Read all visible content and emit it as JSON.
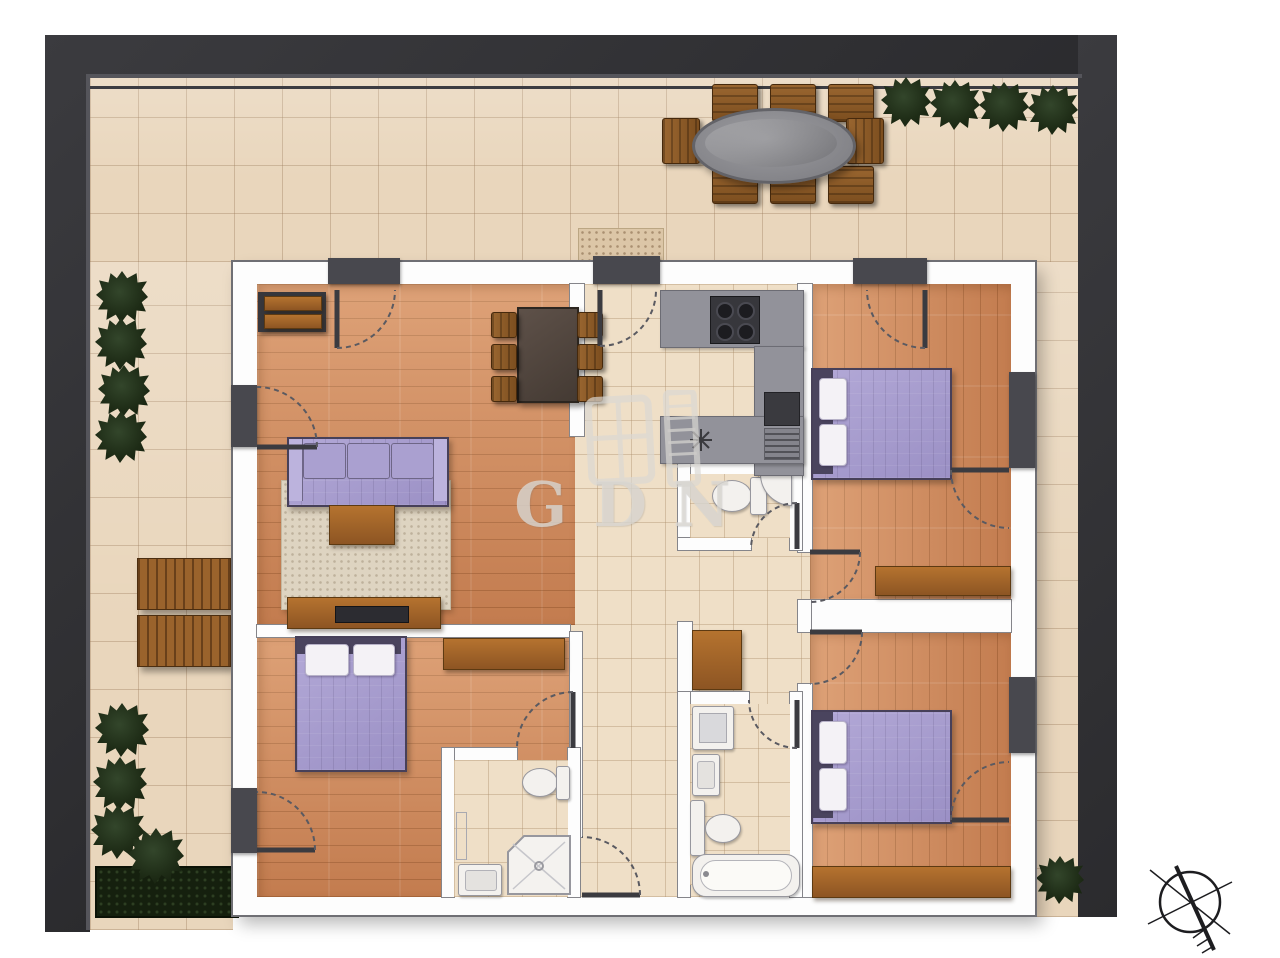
{
  "watermark": {
    "text": "GDN",
    "logo": "window-shutter-icon"
  },
  "compass": {
    "icon": "north-arrow-compass",
    "position": "bottom-right"
  },
  "palette": {
    "frame_dark": "#313135",
    "terrace_tile": "#e9d6bc",
    "indoor_tile": "#efdfc7",
    "wood_floor": "#d1885a",
    "wall_white": "#fdfdfd",
    "counter_gray": "#92929a",
    "appliance_dark": "#37373c",
    "upholstery_purple": "#a79dcd",
    "furniture_wood": "#a0642b",
    "plant_green": "#1f2d17",
    "sanitary_white": "#f3f1ee"
  },
  "floor_plan": {
    "type": "apartment-top-view-render",
    "outdoor": {
      "terrace_shape": "L-wraparound with right-side balcony strip",
      "dining_set": {
        "table": "oval-glass-top",
        "chairs": 8
      },
      "sun_loungers": 2,
      "potted_plants": 12,
      "planter_bed": 1,
      "entry_mat": 1
    },
    "rooms": [
      {
        "name": "living-room",
        "floor": "wood",
        "furniture": [
          "sideboard",
          "dining-table",
          "dining-chairs-x6",
          "sofa-3-seat",
          "rug",
          "coffee-table",
          "tv-console",
          "tv"
        ]
      },
      {
        "name": "kitchen",
        "floor": "tile",
        "furniture": [
          "u-shaped-counter",
          "cooktop-4-burner",
          "sink-basin",
          "faucet-symbol"
        ]
      },
      {
        "name": "hallway",
        "floor": "tile",
        "furniture": [
          "closet-cabinet"
        ]
      },
      {
        "name": "wc",
        "floor": "tile",
        "furniture": [
          "toilet",
          "corner-sink"
        ]
      },
      {
        "name": "bathroom-central",
        "floor": "tile",
        "furniture": [
          "washing-machine",
          "sink",
          "toilet",
          "bathtub"
        ]
      },
      {
        "name": "bedroom-top-right",
        "floor": "wood",
        "furniture": [
          "double-bed",
          "pillows-x2",
          "bench"
        ]
      },
      {
        "name": "bedroom-bottom-right",
        "floor": "wood",
        "furniture": [
          "double-bed",
          "pillows-x2",
          "sideboard"
        ]
      },
      {
        "name": "bedroom-bottom-left",
        "floor": "wood",
        "furniture": [
          "double-bed",
          "pillows-x2",
          "sideboard"
        ]
      },
      {
        "name": "ensuite-bathroom",
        "floor": "tile",
        "furniture": [
          "toilet",
          "corner-shower",
          "sink",
          "towel-rail"
        ]
      }
    ],
    "doors": 13,
    "balcony_doors": 2
  }
}
